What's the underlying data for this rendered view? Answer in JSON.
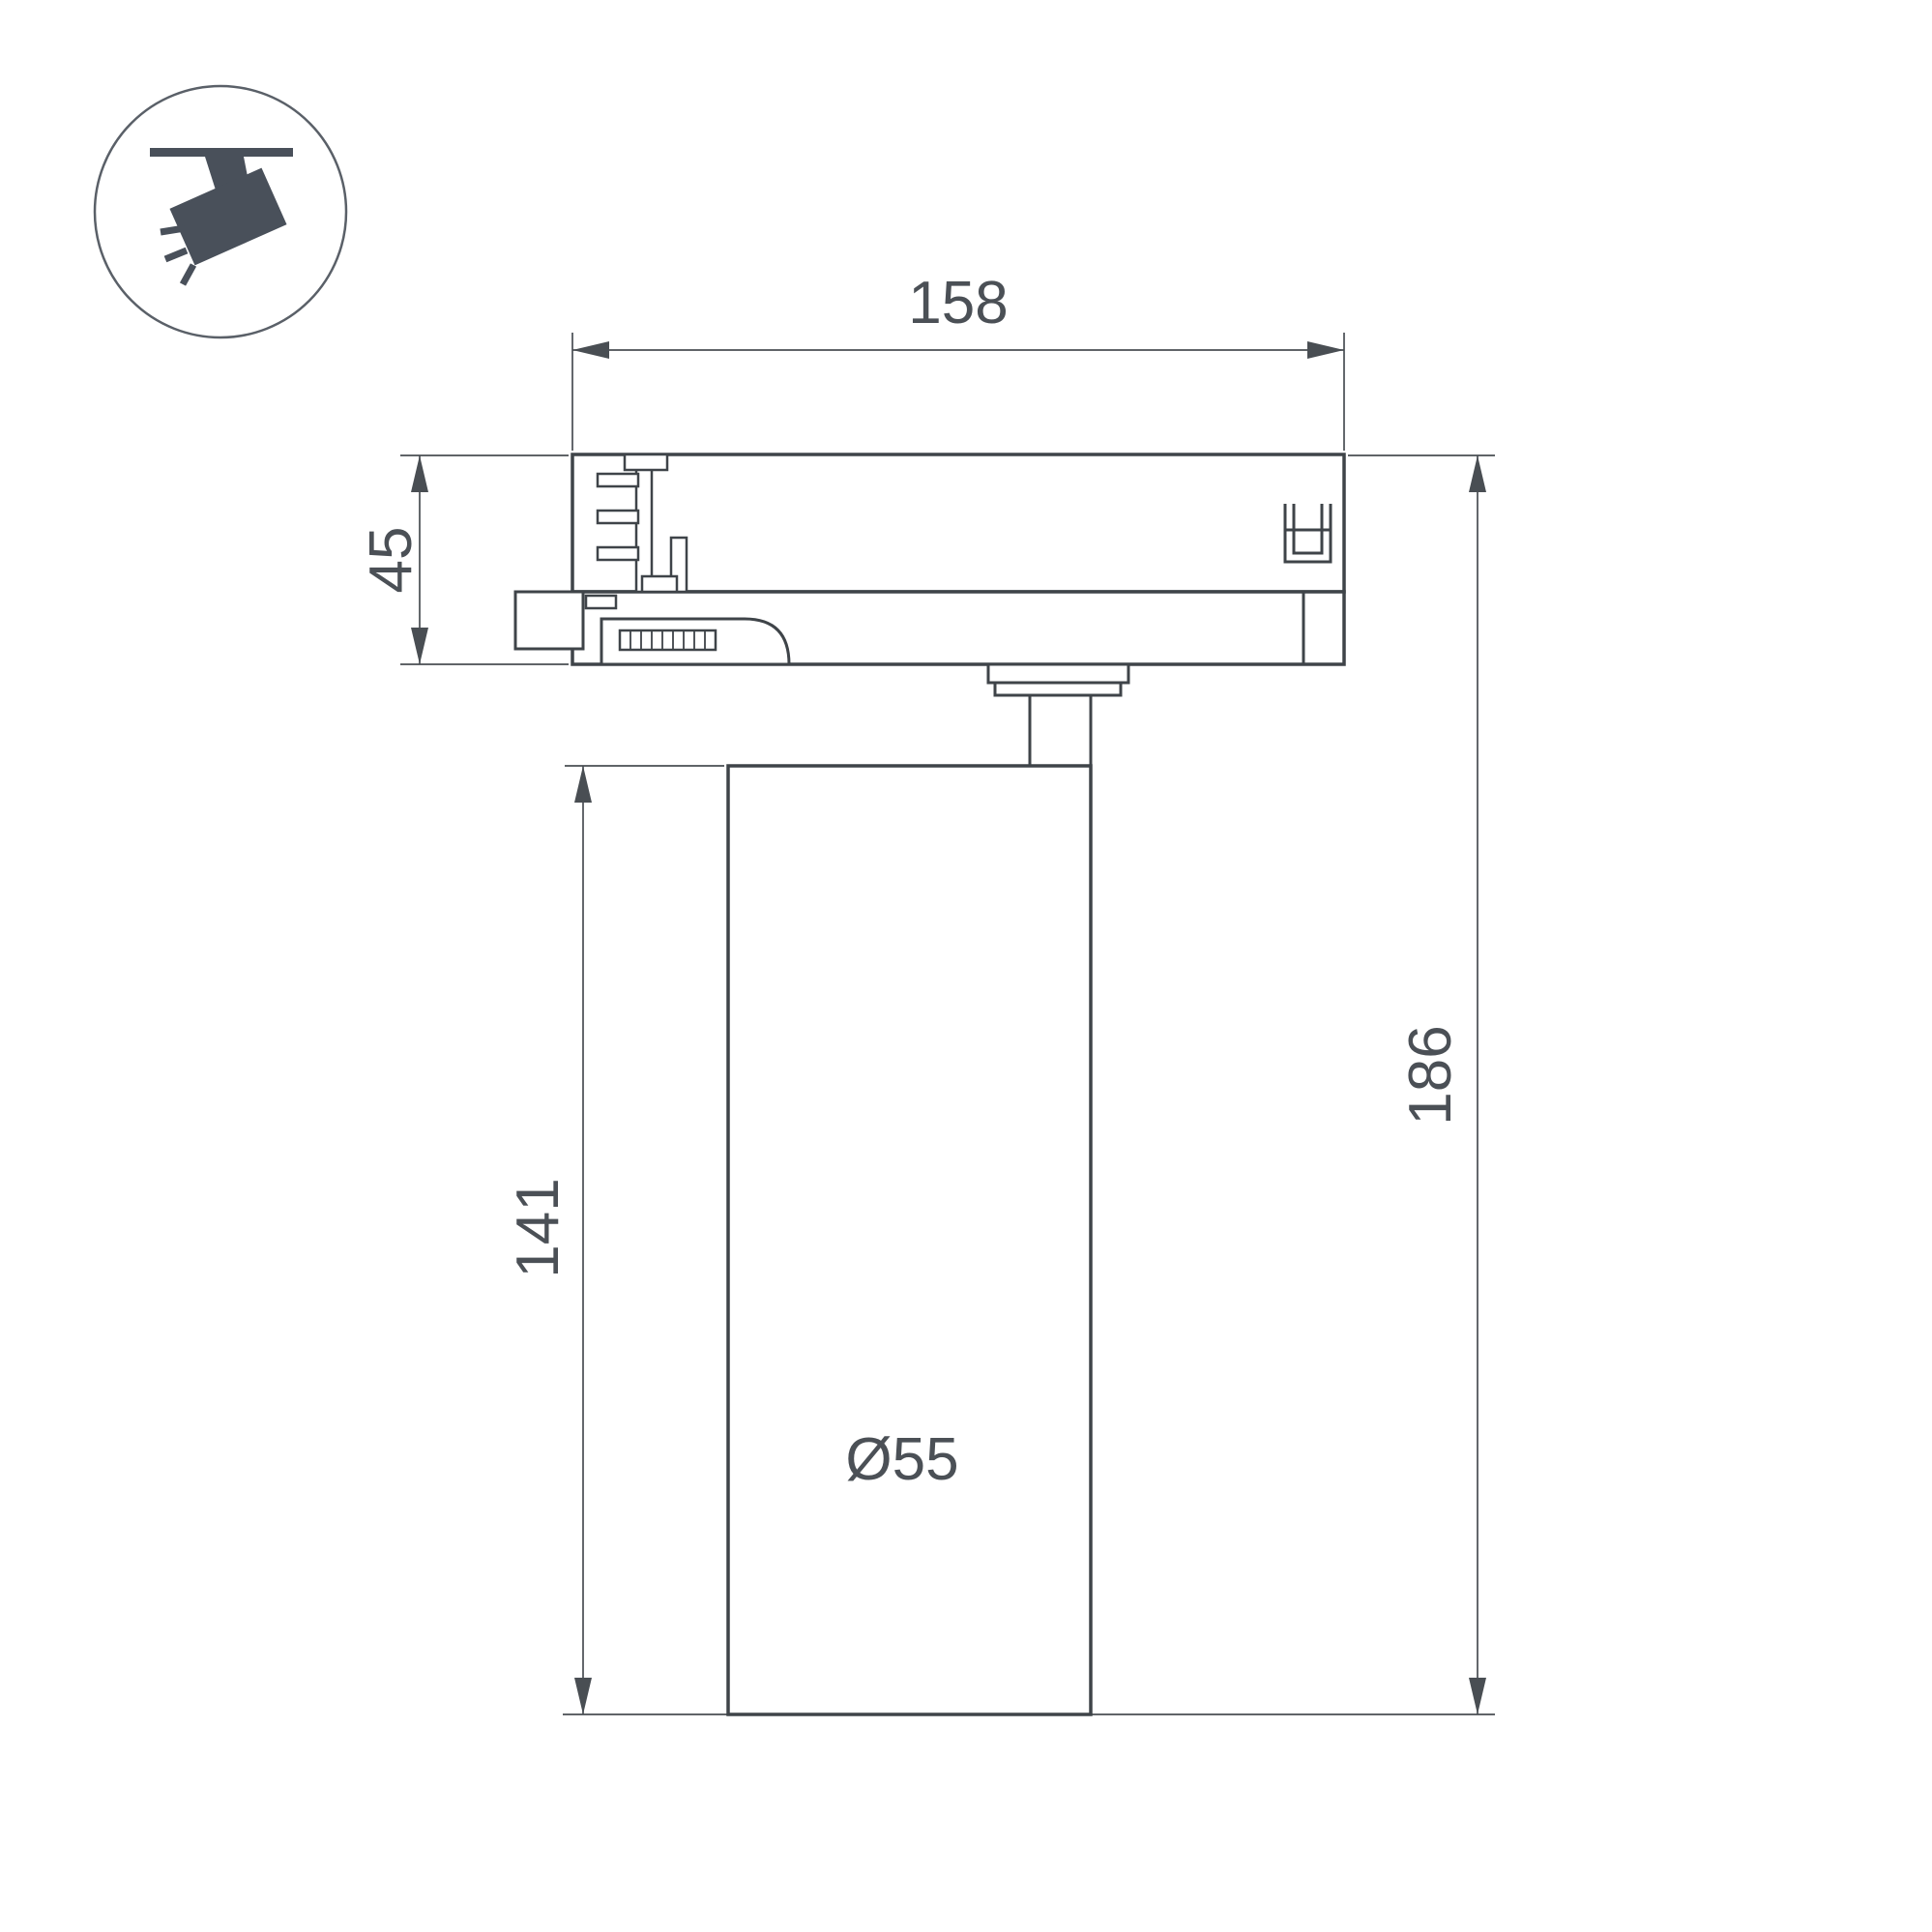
{
  "palette": {
    "background": "#ffffff",
    "outline_color": "#3f4449",
    "dimension_color": "#494e53",
    "text_color": "#4b5056",
    "icon_color": "#49505a",
    "icon_circle_stroke": "#5a6068"
  },
  "icon": {
    "name": "track-spotlight-pictogram"
  },
  "dims": {
    "width_top": "158",
    "adapter_height": "45",
    "body_height": "141",
    "total_height": "186",
    "diameter": "Ø55"
  }
}
